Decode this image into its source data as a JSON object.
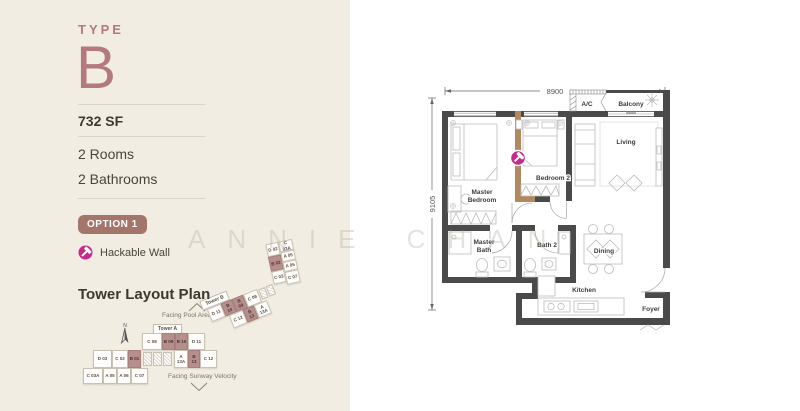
{
  "panel": {
    "type_label": "TYPE",
    "type_value": "B",
    "area": "732 SF",
    "rooms": "2 Rooms",
    "bathrooms": "2 Bathrooms",
    "option_badge": "OPTION 1",
    "legend_hackable": "Hackable Wall",
    "tower_heading": "Tower Layout Plan"
  },
  "watermark": "ANNIE CHAN",
  "tower_map": {
    "tower_a_label": "Tower A",
    "tower_b_label": "Tower B",
    "facing_pool": "Facing Pool Area",
    "facing_sunway": "Facing Sunway Velocity",
    "north": "N",
    "tower_a": {
      "top": [
        {
          "label": "C 08",
          "highlighted": false
        },
        {
          "label": "B 09",
          "highlighted": true
        },
        {
          "label": "B 10",
          "highlighted": true
        },
        {
          "label": "D 11",
          "highlighted": false
        }
      ],
      "mid": [
        {
          "label": "D 03",
          "highlighted": false
        },
        {
          "label": "C 02",
          "highlighted": false
        },
        {
          "label": "B 01",
          "highlighted": true
        },
        {
          "label": "A 13A",
          "highlighted": false
        },
        {
          "label": "B 13",
          "highlighted": true
        },
        {
          "label": "C 12",
          "highlighted": false
        }
      ],
      "bottom": [
        {
          "label": "C 03A",
          "highlighted": false
        },
        {
          "label": "A 05",
          "highlighted": false
        },
        {
          "label": "A 06",
          "highlighted": false
        },
        {
          "label": "C 07",
          "highlighted": false
        }
      ]
    },
    "tower_b": {
      "strip_top": [
        {
          "label": "D 11",
          "highlighted": false
        },
        {
          "label": "B 10",
          "highlighted": true
        },
        {
          "label": "B 09",
          "highlighted": true
        },
        {
          "label": "C 08",
          "highlighted": false
        }
      ],
      "strip_bottom": [
        {
          "label": "C 12",
          "highlighted": false
        },
        {
          "label": "B 13",
          "highlighted": true
        },
        {
          "label": "A 13A",
          "highlighted": false
        }
      ],
      "chain_left": [
        {
          "label": "D 02",
          "highlighted": false
        },
        {
          "label": "B 02",
          "highlighted": true
        },
        {
          "label": "C 03",
          "highlighted": false
        }
      ],
      "chain_right": [
        {
          "label": "C 03A",
          "highlighted": false
        },
        {
          "label": "A 05",
          "highlighted": false
        },
        {
          "label": "A 06",
          "highlighted": false
        },
        {
          "label": "C 07",
          "highlighted": false
        }
      ]
    }
  },
  "plan": {
    "dim_width": "8900",
    "dim_height": "9105",
    "labels": {
      "ac": "A/C",
      "balcony": "Balcony",
      "living": "Living",
      "master_bedroom_1": "Master",
      "master_bedroom_2": "Bedroom",
      "bedroom2": "Bedroom 2",
      "master_bath_1": "Master",
      "master_bath_2": "Bath",
      "bath2": "Bath 2",
      "dining": "Dining",
      "kitchen": "Kitchen",
      "foyer": "Foyer"
    }
  },
  "colors": {
    "cream_bg": "#f2ede2",
    "accent_mauve": "#b3797c",
    "badge_brown": "#a4756a",
    "magenta": "#c8298c",
    "hackable_wall": "#b2895f",
    "wall": "#4a4a4a",
    "highlight_unit": "#b68e8c"
  }
}
